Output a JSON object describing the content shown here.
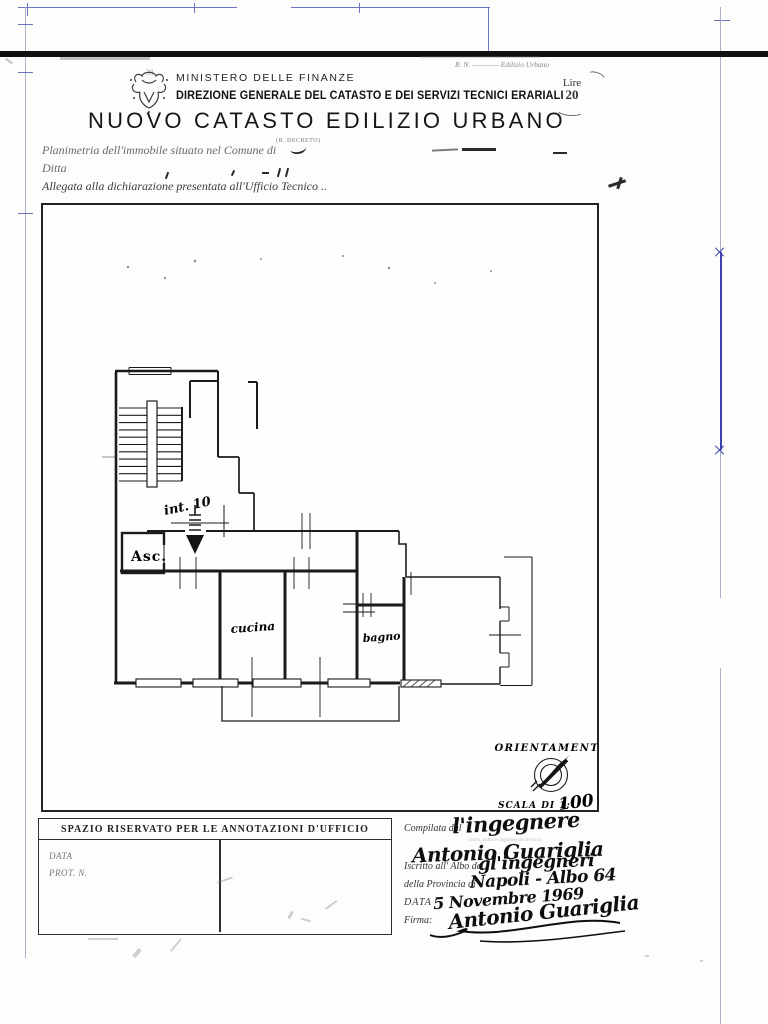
{
  "page": {
    "corner_note": "B. N. ———— Edilizio Urbano",
    "faint_mark": "31",
    "stamp": {
      "line1": "Lire",
      "line2": "20"
    }
  },
  "header": {
    "ministry": "MINISTERO DELLE FINANZE",
    "directorate": "DIREZIONE GENERALE DEL CATASTO E DEI SERVIZI TECNICI ERARIALI",
    "title": "NUOVO CATASTO EDILIZIO URBANO",
    "decree": "(R. DECRETO)"
  },
  "form": {
    "line1": "Planimetria dell'immobile situato nel Comune di",
    "line2": "Ditta",
    "line3": "Allegata alla dichiarazione presentata all'Ufficio Tecnico .."
  },
  "plan": {
    "labels": {
      "elevator": "Asc.",
      "unit": "int. 10",
      "kitchen": "cucina",
      "bath": "bagno"
    },
    "orientation_title": "ORIENTAMENTO",
    "scale_label": "SCALA DI 1:",
    "scale_value": "100"
  },
  "office_box": {
    "title": "SPAZIO RISERVATO PER LE ANNOTAZIONI D'UFFICIO",
    "data_label": "DATA",
    "prot_label": "PROT. N."
  },
  "signature_block": {
    "compiled_by_label": "Compilata dal",
    "compiled_by_hint": "(titolo, nome e cognome del tecnico)",
    "compiled_by_hw": "l'ingegnere",
    "name_hw": "Antonio Guariglia",
    "register_label": "Iscritto all' Albo de",
    "register_hw": "gl'ingegneri",
    "province_label": "della Provincia di",
    "province_hw": "Napoli - Albo 64",
    "date_label": "DATA",
    "date_hw": "5 Novembre 1969",
    "signature_label": "Firma:",
    "signature_hw": "Antonio Guariglia"
  }
}
